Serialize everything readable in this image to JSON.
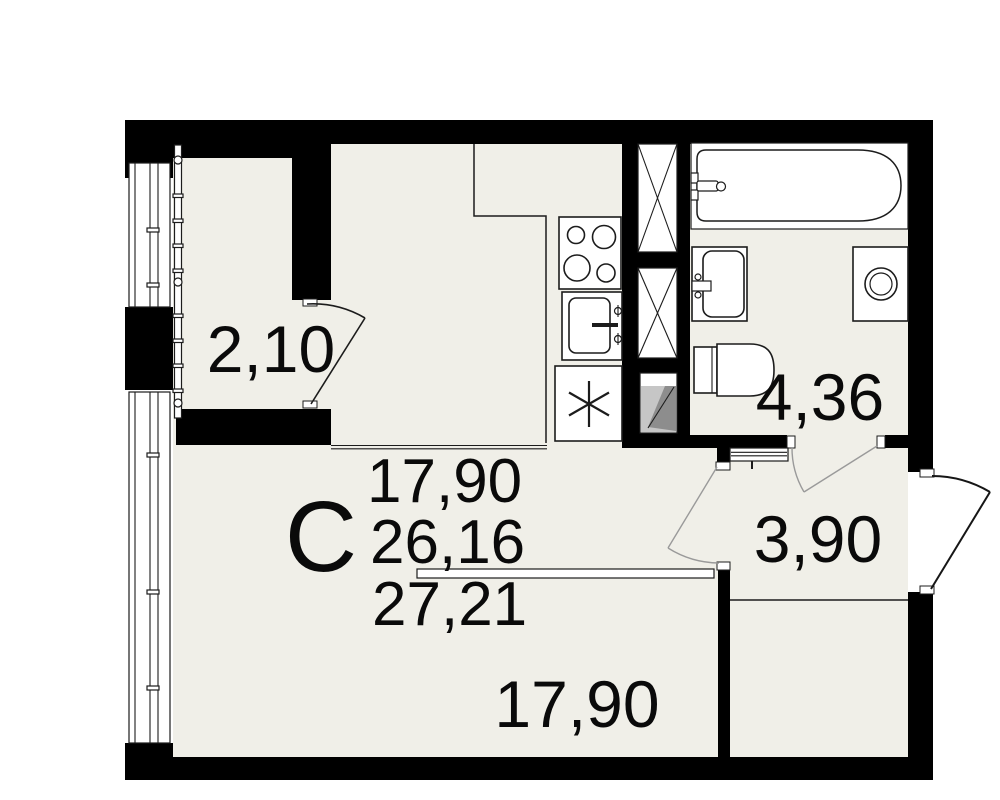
{
  "plan": {
    "unit_type_label": "С",
    "area_table": {
      "line1": "17,90",
      "line2": "26,16",
      "line3": "27,21"
    },
    "rooms": {
      "balcony": "2,10",
      "bathroom": "4,36",
      "hallway": "3,90",
      "living_room": "17,90"
    },
    "colors": {
      "floor": "#f0efe8",
      "wall": "#000000",
      "line": "#1c1c1c",
      "shaft_light": "#c6c6c6",
      "shaft_dark": "#8d8d8d",
      "door_swing": "#9a9a9a",
      "text": "#0a0a0a",
      "background": "#ffffff"
    },
    "symbols": [
      "bathtub",
      "bathroom-sink",
      "washing-machine",
      "toilet",
      "gas-stove",
      "kitchen-sink",
      "refrigerator",
      "ventilation-shaft",
      "duct",
      "electrical-panel",
      "balcony-glazing",
      "window",
      "door-swing",
      "entrance-door-swing"
    ]
  }
}
